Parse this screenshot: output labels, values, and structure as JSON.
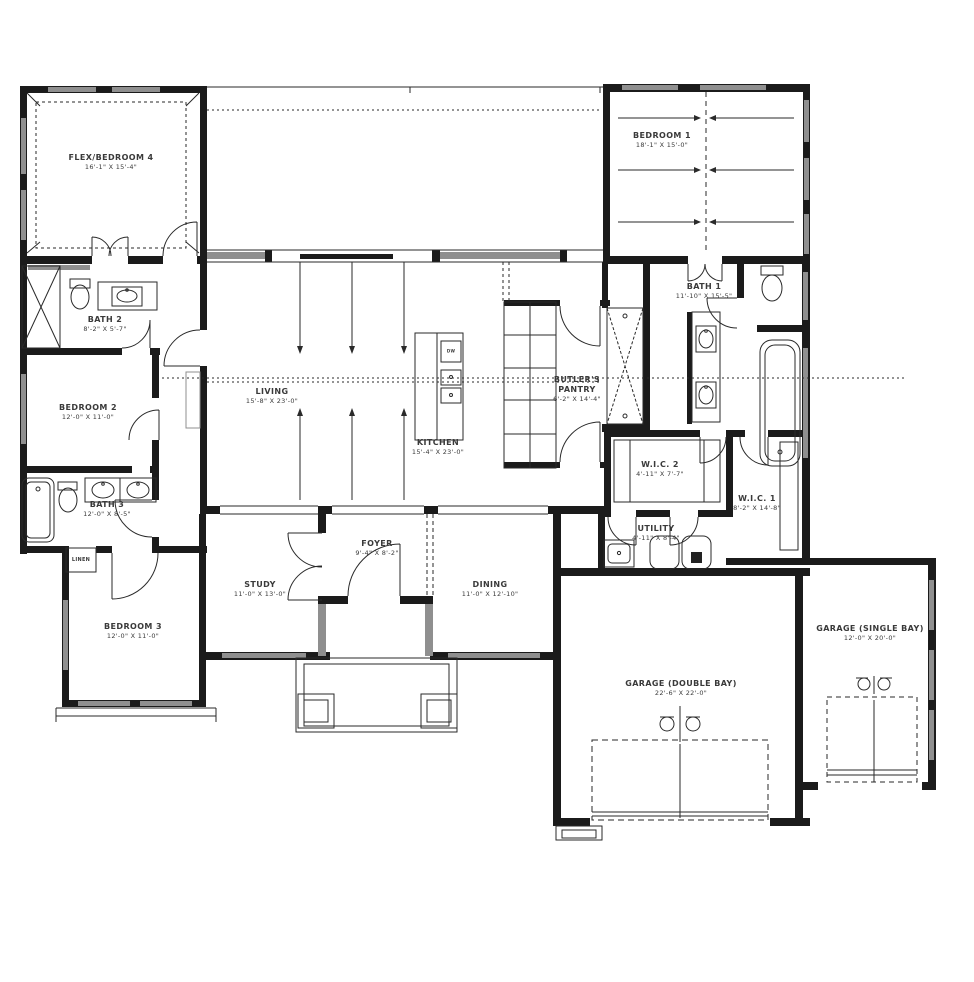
{
  "plan": {
    "rooms": [
      {
        "name": "FLEX/BEDROOM 4",
        "dims": "16'-1\" X 15'-4\""
      },
      {
        "name": "BEDROOM 1",
        "dims": "18'-1\" X 15'-0\""
      },
      {
        "name": "BATH 2",
        "dims": "8'-2\" X 5'-7\""
      },
      {
        "name": "BEDROOM 2",
        "dims": "12'-0\" X 11'-0\""
      },
      {
        "name": "BATH 3",
        "dims": "12'-0\" X 8'-5\""
      },
      {
        "name": "BEDROOM 3",
        "dims": "12'-0\" X 11'-0\""
      },
      {
        "name": "LIVING",
        "dims": "15'-8\" X 23'-0\""
      },
      {
        "name": "KITCHEN",
        "dims": "15'-4\" X 23'-0\""
      },
      {
        "name": "BUTLER'S PANTRY",
        "dims": "6'-2\" X 14'-4\""
      },
      {
        "name": "BATH 1",
        "dims": "11'-10\" X 15'-5\""
      },
      {
        "name": "W.I.C. 2",
        "dims": "4'-11\" X 7'-7\""
      },
      {
        "name": "W.I.C. 1",
        "dims": "8'-2\" X 14'-8\""
      },
      {
        "name": "UTILITY",
        "dims": "4'-11\" X 8'-4\""
      },
      {
        "name": "STUDY",
        "dims": "11'-0\" X 13'-0\""
      },
      {
        "name": "FOYER",
        "dims": "9'-4\" X 8'-2\""
      },
      {
        "name": "DINING",
        "dims": "11'-0\" X 12'-10\""
      },
      {
        "name": "GARAGE (DOUBLE BAY)",
        "dims": "22'-6\" X 22'-0\""
      },
      {
        "name": "GARAGE (SINGLE BAY)",
        "dims": "12'-0\" X 20'-0\""
      }
    ],
    "closet_label": "LINEN",
    "appliance_label": "DW",
    "colors": {
      "wall": "#1b1b1b",
      "window": "#8f8f8f",
      "label": "#3a3a3a"
    }
  }
}
